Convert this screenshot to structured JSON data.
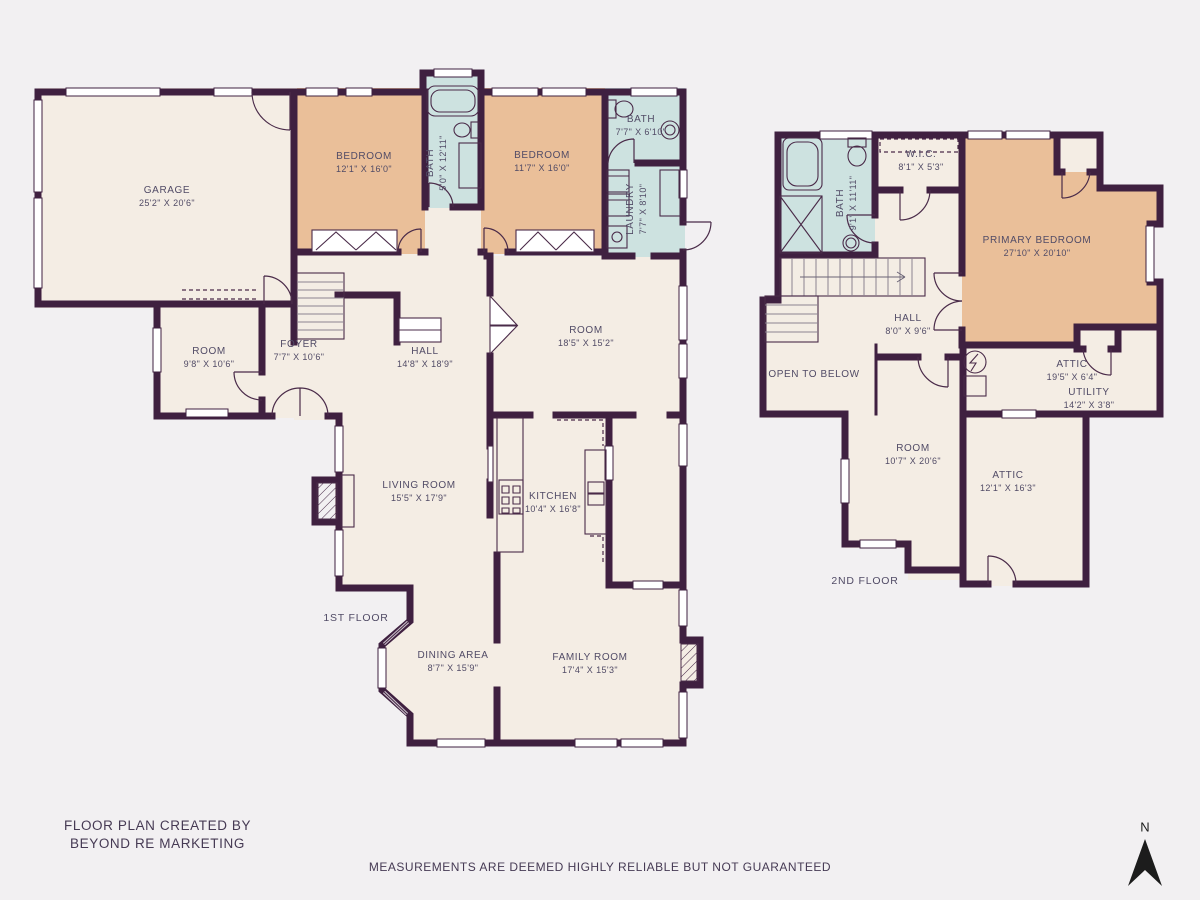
{
  "colors": {
    "bg": "#f2f0f2",
    "wall": "#3f2040",
    "thinline": "#4a2b49",
    "floor": "#f4ede4",
    "bedroom": "#eabf99",
    "bath": "#cde2e0",
    "label": "#514b66",
    "footer": "#463a54"
  },
  "footer": {
    "credit_line1": "FLOOR PLAN CREATED BY",
    "credit_line2": "BEYOND RE MARKETING",
    "disclaimer": "MEASUREMENTS ARE DEEMED HIGHLY RELIABLE BUT NOT GUARANTEED"
  },
  "compass": {
    "label": "N"
  },
  "floor_labels": [
    {
      "text": "1ST FLOOR",
      "x": 356,
      "y": 618
    },
    {
      "text": "2ND FLOOR",
      "x": 865,
      "y": 581
    }
  ],
  "room_labels": [
    {
      "name": "GARAGE",
      "dims": "25'2\" X 20'6\"",
      "x": 167,
      "y": 197,
      "rot": 0
    },
    {
      "name": "BEDROOM",
      "dims": "12'1\" X 16'0\"",
      "x": 364,
      "y": 163,
      "rot": 0
    },
    {
      "name": "BATH",
      "dims": "5'0\" X 12'11\"",
      "x": 437,
      "y": 163,
      "rot": -90
    },
    {
      "name": "BEDROOM",
      "dims": "11'7\" X 16'0\"",
      "x": 542,
      "y": 162,
      "rot": 0
    },
    {
      "name": "BATH",
      "dims": "7'7\" X 6'10\"",
      "x": 641,
      "y": 126,
      "rot": 0
    },
    {
      "name": "LAUNDRY",
      "dims": "7'7\" X 8'10\"",
      "x": 637,
      "y": 209,
      "rot": -90
    },
    {
      "name": "ROOM",
      "dims": "9'8\" X 10'6\"",
      "x": 209,
      "y": 358,
      "rot": 0
    },
    {
      "name": "FOYER",
      "dims": "7'7\" X 10'6\"",
      "x": 299,
      "y": 351,
      "rot": 0
    },
    {
      "name": "HALL",
      "dims": "14'8\" X 18'9\"",
      "x": 425,
      "y": 358,
      "rot": 0
    },
    {
      "name": "ROOM",
      "dims": "18'5\" X 15'2\"",
      "x": 586,
      "y": 337,
      "rot": 0
    },
    {
      "name": "LIVING ROOM",
      "dims": "15'5\" X 17'9\"",
      "x": 419,
      "y": 492,
      "rot": 0
    },
    {
      "name": "KITCHEN",
      "dims": "10'4\" X 16'8\"",
      "x": 553,
      "y": 503,
      "rot": 0
    },
    {
      "name": "DINING AREA",
      "dims": "8'7\" X 15'9\"",
      "x": 453,
      "y": 662,
      "rot": 0
    },
    {
      "name": "FAMILY ROOM",
      "dims": "17'4\" X 15'3\"",
      "x": 590,
      "y": 664,
      "rot": 0
    },
    {
      "name": "BATH",
      "dims": "9'1\" X 11'11\"",
      "x": 847,
      "y": 203,
      "rot": -90
    },
    {
      "name": "W.I.C.",
      "dims": "8'1\" X 5'3\"",
      "x": 921,
      "y": 161,
      "rot": 0
    },
    {
      "name": "PRIMARY BEDROOM",
      "dims": "27'10\" X 20'10\"",
      "x": 1037,
      "y": 247,
      "rot": 0
    },
    {
      "name": "HALL",
      "dims": "8'0\" X 9'6\"",
      "x": 908,
      "y": 325,
      "rot": 0
    },
    {
      "name": "OPEN TO BELOW",
      "dims": "",
      "x": 814,
      "y": 375,
      "rot": 0
    },
    {
      "name": "ATTIC",
      "dims": "19'5\" X 6'4\"",
      "x": 1072,
      "y": 371,
      "rot": 0
    },
    {
      "name": "UTILITY",
      "dims": "14'2\" X 3'8\"",
      "x": 1089,
      "y": 399,
      "rot": 0
    },
    {
      "name": "ROOM",
      "dims": "10'7\" X 20'6\"",
      "x": 913,
      "y": 455,
      "rot": 0
    },
    {
      "name": "ATTIC",
      "dims": "12'1\" X 16'3\"",
      "x": 1008,
      "y": 482,
      "rot": 0
    }
  ]
}
